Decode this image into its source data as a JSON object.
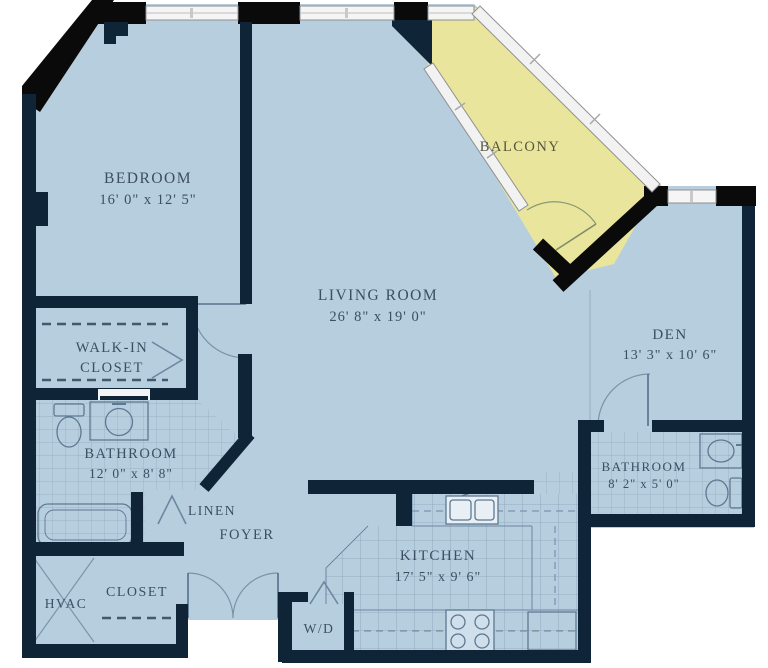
{
  "plan": {
    "bedroom": {
      "label": "BEDROOM",
      "dims": "16' 0\" x 12' 5\""
    },
    "living_room": {
      "label": "LIVING ROOM",
      "dims": "26' 8\" x 19' 0\""
    },
    "balcony": {
      "label": "BALCONY"
    },
    "den": {
      "label": "DEN",
      "dims": "13' 3\" x 10' 6\""
    },
    "walk_in_closet": {
      "label_line1": "WALK-IN",
      "label_line2": "CLOSET"
    },
    "bathroom_main": {
      "label": "BATHROOM",
      "dims": "12' 0\" x 8' 8\""
    },
    "linen": {
      "label": "LINEN"
    },
    "foyer": {
      "label": "FOYER"
    },
    "kitchen": {
      "label": "KITCHEN",
      "dims": "17' 5\" x 9' 6\""
    },
    "bathroom_second": {
      "label": "BATHROOM",
      "dims": "8' 2\" x 5' 0\""
    },
    "hvac": {
      "label": "HVAC"
    },
    "closet": {
      "label": "CLOSET"
    },
    "washer_dryer": {
      "label": "W/D"
    }
  },
  "colors": {
    "floor": "#b7cedf",
    "balcony": "#e9e59c",
    "wall": "#0f2437",
    "black_block": "#0a0a0a",
    "text": "#3d4e63",
    "tile_line": "#8fa7bc",
    "window_fill": "#f5f5f5"
  }
}
